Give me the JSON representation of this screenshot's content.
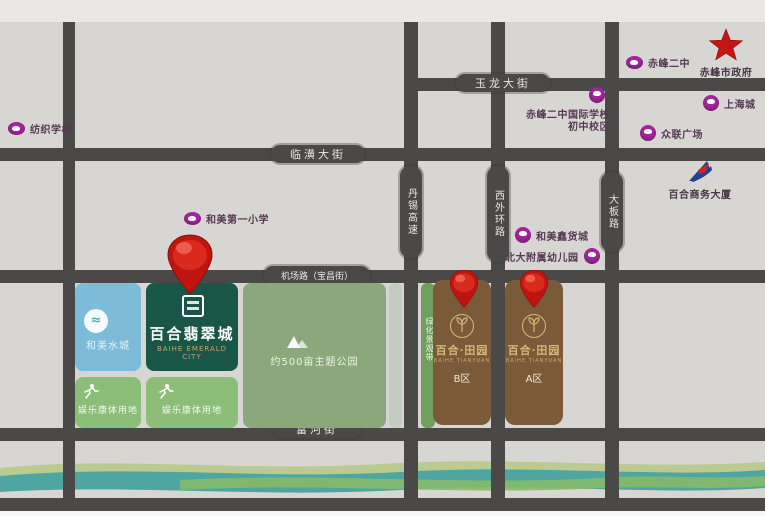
{
  "title": "百合翡翠城区位图",
  "colors": {
    "background": "#d8d6d3",
    "road": "#4a4947",
    "landmark_purple": "#a1269c",
    "star_red": "#c41616",
    "pin_red": "#c8140e",
    "emerald_green": "#1a5648",
    "water_blue": "#7cbcd8",
    "rec_green": "#8cbe79",
    "park_green": "#8aa87b",
    "belt_green": "#6f9e5f",
    "tianyuan_brown": "#7a5a38",
    "river_teal": "#4fa6a1",
    "gold": "#d9b87c"
  },
  "roads": {
    "yulong": "玉龙大街",
    "linhuang": "临潢大街",
    "jichang": "机场路（宝昌街）",
    "fuhe": "富河街",
    "danxi": "丹锡高速",
    "xiwaihuan": "西外环路",
    "daban": "大板路"
  },
  "landmarks": {
    "fangzhi": "纺织学校",
    "hemei_school": "和美第一小学",
    "cf_erzhong": "赤峰二中",
    "government": "赤峰市政府",
    "shanghai_city": "上海城",
    "zhonglian": "众联广场",
    "intl_school_line1": "赤峰二中国际学校",
    "intl_school_line2": "初中校区",
    "hemei_market": "和美鑫货城",
    "kindergarten": "北大附属幼儿园",
    "baihe_tower": "百合商务大厦"
  },
  "blocks": {
    "water_city": "和美水城",
    "emerald_name": "百合翡翠城",
    "emerald_english": "BAIHE EMERALD CITY",
    "rec1": "娱乐康体用地",
    "rec2": "娱乐康体用地",
    "park": "约500亩主题公园",
    "green_belt": "绿化景观带",
    "tianyuan_title_b": "百合·田园",
    "tianyuan_title_a": "百合·田园",
    "tianyuan_english": "BAIHE TIANYUAN",
    "zone_b": "B区",
    "zone_a": "A区"
  }
}
